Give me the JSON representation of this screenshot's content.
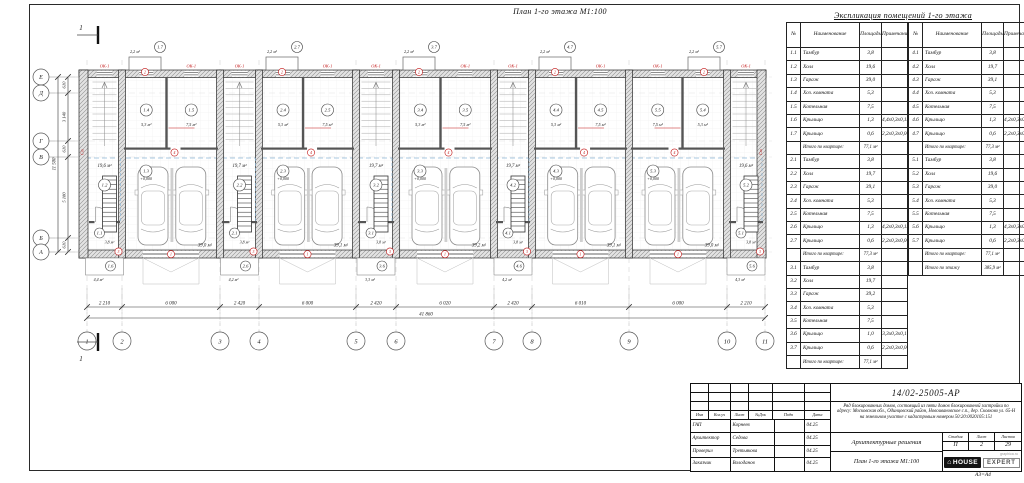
{
  "sheet": {
    "format_note": "А3=А4"
  },
  "plan": {
    "title": "План 1-го этажа М1:100",
    "section_mark": "1",
    "window_mark": "ОК-1",
    "wall_mark": "Ст",
    "elevation": "+0,000",
    "axes_bottom": [
      "1",
      "2",
      "3",
      "4",
      "5",
      "6",
      "7",
      "8",
      "9",
      "10",
      "11"
    ],
    "axes_left": [
      "Е",
      "Д",
      "Г",
      "В",
      "Б",
      "А"
    ],
    "dims_bottom": [
      "2 210",
      "6 000",
      "2 420",
      "6 000",
      "2 420",
      "6 020",
      "2 420",
      "6 010",
      "6 000",
      "2 210"
    ],
    "dim_total_bottom": "41 860",
    "dims_left": [
      "610",
      "3 140",
      "610",
      "5 180",
      "610"
    ],
    "dim_total_left": "11 500",
    "door_tags": {
      "gate": "1",
      "porch_top": "2",
      "tambour": "3",
      "service": "4"
    },
    "units": [
      {
        "hall_tag": "1.2",
        "hall_area": "19,6 м²",
        "tambour_tag": "1.1",
        "tambour_area": "3,8 м²",
        "garage_tag": "1.3",
        "garage_area": "39,0 м²",
        "utility_tag": "1.4",
        "utility_area": "5,3 м²",
        "boiler_tag": "1.5",
        "boiler_area": "7,5 м²",
        "porch_bottom_tag": "1.6",
        "porch_bottom_area": "4,4 м²",
        "porch_top_tag": "1.7",
        "porch_top_area": "2,2 м²"
      },
      {
        "hall_tag": "2.2",
        "hall_area": "19,7 м²",
        "tambour_tag": "2.1",
        "tambour_area": "3,8 м²",
        "garage_tag": "2.3",
        "garage_area": "39,1 м²",
        "utility_tag": "2.4",
        "utility_area": "5,3 м²",
        "boiler_tag": "2.5",
        "boiler_area": "7,5 м²",
        "porch_bottom_tag": "2.6",
        "porch_bottom_area": "4,2 м²",
        "porch_top_tag": "2.7",
        "porch_top_area": "2,2 м²"
      },
      {
        "hall_tag": "3.2",
        "hall_area": "19,7 м²",
        "tambour_tag": "3.1",
        "tambour_area": "3,8 м²",
        "garage_tag": "3.3",
        "garage_area": "39,2 м²",
        "utility_tag": "3.4",
        "utility_area": "5,3 м²",
        "boiler_tag": "3.5",
        "boiler_area": "7,5 м²",
        "porch_bottom_tag": "3.6",
        "porch_bottom_area": "3,3 м²",
        "porch_top_tag": "3.7",
        "porch_top_area": "2,2 м²"
      },
      {
        "hall_tag": "4.2",
        "hall_area": "19,7 м²",
        "tambour_tag": "4.1",
        "tambour_area": "3,8 м²",
        "garage_tag": "4.3",
        "garage_area": "39,1 м²",
        "utility_tag": "4.4",
        "utility_area": "5,3 м²",
        "boiler_tag": "4.5",
        "boiler_area": "7,5 м²",
        "porch_bottom_tag": "4.6",
        "porch_bottom_area": "4,2 м²",
        "porch_top_tag": "4.7",
        "porch_top_area": "2,2 м²"
      },
      {
        "hall_tag": "5.2",
        "hall_area": "19,6 м²",
        "tambour_tag": "5.1",
        "tambour_area": "3,8 м²",
        "garage_tag": "5.3",
        "garage_area": "39,0 м²",
        "utility_tag": "5.4",
        "utility_area": "5,3 м²",
        "boiler_tag": "5.5",
        "boiler_area": "7,5 м²",
        "porch_bottom_tag": "5.6",
        "porch_bottom_area": "4,3 м²",
        "porch_top_tag": "5.7",
        "porch_top_area": "2,2 м²"
      }
    ]
  },
  "explication": {
    "title": "Экспликация помещений 1-го этажа",
    "columns": [
      "№",
      "Наименование",
      "Площадь",
      "Примечание"
    ],
    "rows_left": [
      [
        "1.1",
        "Тамбур",
        "3,8",
        ""
      ],
      [
        "1.2",
        "Холл",
        "19,6",
        ""
      ],
      [
        "1.3",
        "Гараж",
        "39,0",
        ""
      ],
      [
        "1.4",
        "Хоз. комната",
        "5,3",
        ""
      ],
      [
        "1.5",
        "Котельная",
        "7,5",
        ""
      ],
      [
        "1.6",
        "Крыльцо",
        "1,3",
        "4,4х0,3х0,13"
      ],
      [
        "1.7",
        "Крыльцо",
        "0,6",
        "2,2х0,3х0,06"
      ],
      [
        "",
        "Итого по квартире:",
        "77,1 м²",
        ""
      ],
      [
        "2.1",
        "Тамбур",
        "3,8",
        ""
      ],
      [
        "2.2",
        "Холл",
        "19,7",
        ""
      ],
      [
        "2.3",
        "Гараж",
        "39,1",
        ""
      ],
      [
        "2.4",
        "Хоз. комната",
        "5,3",
        ""
      ],
      [
        "2.5",
        "Котельная",
        "7,5",
        ""
      ],
      [
        "2.6",
        "Крыльцо",
        "1,3",
        "4,2х0,3х0,13"
      ],
      [
        "2.7",
        "Крыльцо",
        "0,6",
        "2,2х0,3х0,06"
      ],
      [
        "",
        "Итого по квартире:",
        "77,3 м²",
        ""
      ],
      [
        "3.1",
        "Тамбур",
        "3,8",
        ""
      ],
      [
        "3.2",
        "Холл",
        "19,7",
        ""
      ],
      [
        "3.3",
        "Гараж",
        "39,2",
        ""
      ],
      [
        "3.4",
        "Хоз. комната",
        "5,3",
        ""
      ],
      [
        "3.5",
        "Котельная",
        "7,5",
        ""
      ],
      [
        "3.6",
        "Крыльцо",
        "1,0",
        "3,3х0,3х0,1"
      ],
      [
        "3.7",
        "Крыльцо",
        "0,6",
        "2,2х0,3х0,06"
      ],
      [
        "",
        "Итого по квартире:",
        "77,1 м²",
        ""
      ]
    ],
    "rows_right": [
      [
        "4.1",
        "Тамбур",
        "3,8",
        ""
      ],
      [
        "4.2",
        "Холл",
        "19,7",
        ""
      ],
      [
        "4.3",
        "Гараж",
        "39,1",
        ""
      ],
      [
        "4.4",
        "Хоз. комната",
        "5,3",
        ""
      ],
      [
        "4.5",
        "Котельная",
        "7,5",
        ""
      ],
      [
        "4.6",
        "Крыльцо",
        "1,3",
        "4,2х0,3х0,13"
      ],
      [
        "4.7",
        "Крыльцо",
        "0,6",
        "2,2х0,3х0,06"
      ],
      [
        "",
        "Итого по квартире:",
        "77,3 м²",
        ""
      ],
      [
        "5.1",
        "Тамбур",
        "3,8",
        ""
      ],
      [
        "5.2",
        "Холл",
        "19,6",
        ""
      ],
      [
        "5.3",
        "Гараж",
        "39,0",
        ""
      ],
      [
        "5.4",
        "Хоз. комната",
        "5,3",
        ""
      ],
      [
        "5.5",
        "Котельная",
        "7,5",
        ""
      ],
      [
        "5.6",
        "Крыльцо",
        "1,3",
        "4,3х0,3х0,13"
      ],
      [
        "5.7",
        "Крыльцо",
        "0,6",
        "2,2х0,3х0,06"
      ],
      [
        "",
        "Итого по квартире:",
        "77,1 м²",
        ""
      ],
      [
        "",
        "Итого по этажу",
        "385,9 м²",
        ""
      ]
    ]
  },
  "title_block": {
    "doc_number": "14/02-25005-АР",
    "description": "Ряд блокированных домов, состоящий из пяти домов блокированной застройки по адресу: Московская обл., Одинцовский район, Новоивановское с.п., дер. Сколково ул. 65-Н на земельном участке с кадастровым номером 50:20:0020105:151",
    "section_title": "Архитектурные решения",
    "sheet_title": "План 1-го этажа М1:100",
    "stage": {
      "labels": [
        "Стадия",
        "Лист",
        "Листов"
      ],
      "values": [
        "П",
        "2",
        "29"
      ]
    },
    "change_header": [
      "Изм",
      "Кол.уч",
      "Лист",
      "№Док",
      "Подп",
      "Дата"
    ],
    "sign_rows": [
      {
        "role": "ГАП",
        "name": "Корнеев",
        "date": "04.25"
      },
      {
        "role": "Архитектор",
        "name": "Седова",
        "date": "04.25"
      },
      {
        "role": "Проверил",
        "name": "Третьякова",
        "date": "04.25"
      },
      {
        "role": "Заказчик",
        "name": "Володанов",
        "date": "04.25"
      }
    ],
    "logo": {
      "text_black": "HOUSE",
      "text_outline": "EXPERT",
      "site": "graphica.ru"
    },
    "icons": {
      "house": "⌂"
    }
  }
}
